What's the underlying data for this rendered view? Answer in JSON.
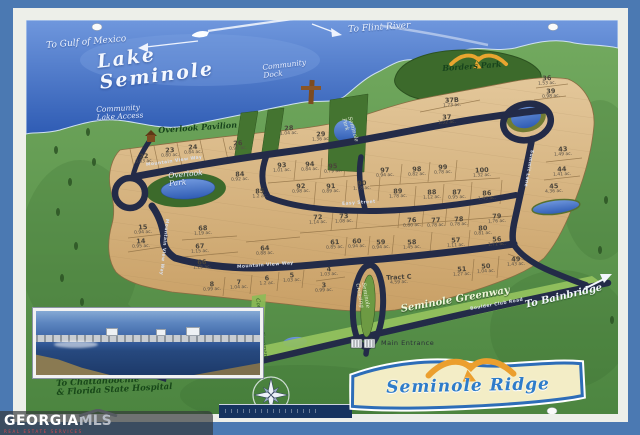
{
  "palette": {
    "frame_blue": "#4b79b2",
    "mat_white": "#edefe9",
    "lake_blue": "#3e6fc4",
    "land_green": "#5f9750",
    "park_green": "#3c6a2b",
    "lot_tan": "#d9b987",
    "road_navy": "#232b48",
    "greenway_green": "#95c25e",
    "sign_cream": "#f3edc6",
    "sign_blue": "#2e7cc9",
    "eagle_gold": "#e8a52f"
  },
  "sign": {
    "title": "Seminole Ridge",
    "eagle_icon": "eagle-icon"
  },
  "watermark": {
    "brand_primary": "GEORGIA",
    "brand_secondary": "MLS",
    "tagline": "REAL ESTATE SERVICES"
  },
  "map": {
    "labels": [
      {
        "text": "Lake\nSeminole",
        "x": 96,
        "y": 52,
        "rot": -7,
        "cls": "lake-title"
      },
      {
        "text": "To Gulf of Mexico",
        "x": 46,
        "y": 42,
        "rot": -5,
        "cls": "dir-label"
      },
      {
        "text": "To Flint River",
        "x": 348,
        "y": 26,
        "rot": -4,
        "cls": "dir-label"
      },
      {
        "text": "Community\nDock",
        "x": 262,
        "y": 64,
        "rot": -7,
        "cls": "water-label"
      },
      {
        "text": "Community\nLake Access",
        "x": 96,
        "y": 106,
        "rot": -3,
        "cls": "water-label"
      },
      {
        "text": "Overlook Pavilion",
        "x": 158,
        "y": 126,
        "rot": -4,
        "cls": "park-label"
      },
      {
        "text": "Borders Park",
        "x": 442,
        "y": 64,
        "rot": -4,
        "cls": "park-label"
      },
      {
        "text": "Overlook\nPark",
        "x": 168,
        "y": 172,
        "rot": -5,
        "cls": "water-label"
      },
      {
        "text": "Seminole\nPark",
        "x": 352,
        "y": 116,
        "rot": 74,
        "cls": "vert-script"
      },
      {
        "text": "Mountain View Way",
        "x": 146,
        "y": 164,
        "rot": -8,
        "cls": "street-label"
      },
      {
        "text": "Easy Street",
        "x": 342,
        "y": 203,
        "rot": -4,
        "cls": "street-label"
      },
      {
        "text": "Mountain View Way",
        "x": 237,
        "y": 266,
        "rot": -4,
        "cls": "street-label"
      },
      {
        "text": "Mountain View Way",
        "x": 168,
        "y": 219,
        "rot": 96,
        "cls": "street-label"
      },
      {
        "text": "Summit Lane",
        "x": 533,
        "y": 150,
        "rot": 100,
        "cls": "street-label"
      },
      {
        "text": "Seminole Greenway",
        "x": 400,
        "y": 304,
        "rot": -10,
        "cls": "greenway-label"
      },
      {
        "text": "Boulder Club Road",
        "x": 470,
        "y": 308,
        "rot": -10,
        "cls": "street-label"
      },
      {
        "text": "To Bainbridge",
        "x": 524,
        "y": 300,
        "rot": -13,
        "cls": "dir-label-lg"
      },
      {
        "text": "Main Entrance",
        "x": 381,
        "y": 340,
        "rot": 0,
        "cls": "entrance-label"
      },
      {
        "text": "To Chattahoochie\n& Florida State Hospital",
        "x": 56,
        "y": 380,
        "rot": -3,
        "cls": "hosp-label"
      },
      {
        "text": "Community Easement",
        "x": 260,
        "y": 298,
        "rot": 82,
        "cls": "easement-label"
      },
      {
        "text": "Seminole\nCrossing",
        "x": 366,
        "y": 282,
        "rot": 80,
        "cls": "vert-script"
      }
    ],
    "lots": [
      {
        "n": "22",
        "a": "0.83 ac.",
        "x": 144,
        "y": 159
      },
      {
        "n": "23",
        "a": "0.80 ac.",
        "x": 170,
        "y": 153
      },
      {
        "n": "24",
        "a": "0.84 ac.",
        "x": 193,
        "y": 150
      },
      {
        "n": "26",
        "a": "0.92 ac.",
        "x": 238,
        "y": 146
      },
      {
        "n": "28",
        "a": "1.04 ac.",
        "x": 289,
        "y": 131
      },
      {
        "n": "29",
        "a": "1.36 ac.",
        "x": 321,
        "y": 137
      },
      {
        "n": "36",
        "a": "1.53 ac.",
        "x": 547,
        "y": 81
      },
      {
        "n": "39",
        "a": "0.98 ac.",
        "x": 551,
        "y": 94
      },
      {
        "n": "37B",
        "a": "1.73 ac.",
        "x": 452,
        "y": 103
      },
      {
        "n": "37",
        "a": "1.52 ac.",
        "x": 447,
        "y": 120
      },
      {
        "n": "43",
        "a": "1.49 ac.",
        "x": 563,
        "y": 152
      },
      {
        "n": "44",
        "a": "1.41 ac.",
        "x": 562,
        "y": 172
      },
      {
        "n": "45",
        "a": "4.36 ac.",
        "x": 554,
        "y": 189
      },
      {
        "n": "84",
        "a": "0.92 ac.",
        "x": 240,
        "y": 177
      },
      {
        "n": "85",
        "a": "1.2 ac.",
        "x": 260,
        "y": 194
      },
      {
        "n": "93",
        "a": "1.01 ac.",
        "x": 282,
        "y": 168
      },
      {
        "n": "94",
        "a": "0.84 ac.",
        "x": 310,
        "y": 167
      },
      {
        "n": "95",
        "a": "0.79 ac.",
        "x": 333,
        "y": 169
      },
      {
        "n": "97",
        "a": "0.94 ac.",
        "x": 385,
        "y": 173
      },
      {
        "n": "98",
        "a": "0.82 ac.",
        "x": 417,
        "y": 172
      },
      {
        "n": "99",
        "a": "0.78 ac.",
        "x": 443,
        "y": 170
      },
      {
        "n": "100",
        "a": "1.32 ac.",
        "x": 482,
        "y": 173
      },
      {
        "n": "92",
        "a": "0.98 ac.",
        "x": 301,
        "y": 189
      },
      {
        "n": "91",
        "a": "0.89 ac.",
        "x": 331,
        "y": 189
      },
      {
        "n": "90",
        "a": "1.18 ac.",
        "x": 362,
        "y": 186
      },
      {
        "n": "89",
        "a": "1.78 ac.",
        "x": 398,
        "y": 194
      },
      {
        "n": "88",
        "a": "1.12 ac.",
        "x": 432,
        "y": 195
      },
      {
        "n": "87",
        "a": "0.95 ac.",
        "x": 457,
        "y": 195
      },
      {
        "n": "86",
        "a": "1.43 ac.",
        "x": 487,
        "y": 196
      },
      {
        "n": "72",
        "a": "1.14 ac.",
        "x": 318,
        "y": 220
      },
      {
        "n": "73",
        "a": "1.08 ac.",
        "x": 344,
        "y": 219
      },
      {
        "n": "76",
        "a": "0.80 ac.",
        "x": 412,
        "y": 223
      },
      {
        "n": "77",
        "a": "0.78 ac.",
        "x": 436,
        "y": 223
      },
      {
        "n": "78",
        "a": "0.78 ac.",
        "x": 459,
        "y": 222
      },
      {
        "n": "79",
        "a": "1.76 ac.",
        "x": 497,
        "y": 219
      },
      {
        "n": "80",
        "a": "0.81 ac.",
        "x": 483,
        "y": 231
      },
      {
        "n": "68",
        "a": "1.19 ac.",
        "x": 203,
        "y": 231
      },
      {
        "n": "67",
        "a": "1.15 ac.",
        "x": 200,
        "y": 249
      },
      {
        "n": "66",
        "a": "1.25 ac.",
        "x": 202,
        "y": 265
      },
      {
        "n": "64",
        "a": "0.88 ac.",
        "x": 265,
        "y": 251
      },
      {
        "n": "15",
        "a": "0.94 ac.",
        "x": 143,
        "y": 230
      },
      {
        "n": "14",
        "a": "0.95 ac.",
        "x": 141,
        "y": 244
      },
      {
        "n": "61",
        "a": "0.85 ac.",
        "x": 335,
        "y": 245
      },
      {
        "n": "60",
        "a": "0.94 ac.",
        "x": 357,
        "y": 244
      },
      {
        "n": "59",
        "a": "0.94 ac.",
        "x": 381,
        "y": 245
      },
      {
        "n": "58",
        "a": "1.45 ac.",
        "x": 412,
        "y": 245
      },
      {
        "n": "57",
        "a": "1.11 ac.",
        "x": 456,
        "y": 243
      },
      {
        "n": "56",
        "a": "1.71 ac.",
        "x": 497,
        "y": 242
      },
      {
        "n": "51",
        "a": "1.27 ac.",
        "x": 462,
        "y": 272
      },
      {
        "n": "50",
        "a": "1.04 ac.",
        "x": 486,
        "y": 269
      },
      {
        "n": "49",
        "a": "1.43 ac.",
        "x": 516,
        "y": 262
      },
      {
        "n": "8",
        "a": "0.99 ac.",
        "x": 212,
        "y": 287
      },
      {
        "n": "7",
        "a": "1.04 ac.",
        "x": 239,
        "y": 285
      },
      {
        "n": "6",
        "a": "1.2 ac.",
        "x": 267,
        "y": 281
      },
      {
        "n": "5",
        "a": "1.03 ac.",
        "x": 292,
        "y": 278
      },
      {
        "n": "4",
        "a": "1.03 ac.",
        "x": 329,
        "y": 272
      },
      {
        "n": "3",
        "a": "0.99 ac.",
        "x": 324,
        "y": 288
      },
      {
        "n": "Tract C",
        "a": "4.59 ac.",
        "x": 399,
        "y": 280
      }
    ]
  }
}
